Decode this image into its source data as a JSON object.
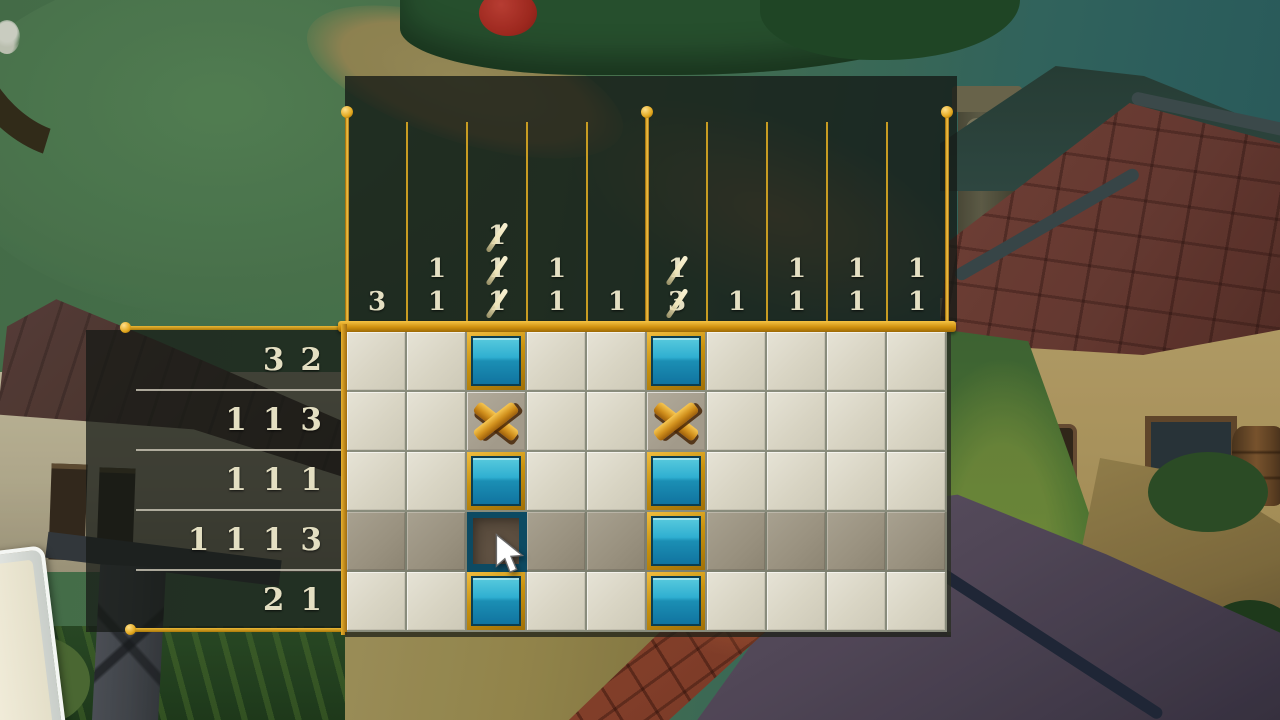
{
  "board": {
    "rows": 5,
    "cols": 10,
    "highlighted_row": 3,
    "hover_cell": {
      "row": 3,
      "col": 2
    },
    "cells": [
      [
        "empty",
        "empty",
        "filled",
        "empty",
        "empty",
        "filled",
        "empty",
        "empty",
        "empty",
        "empty"
      ],
      [
        "empty",
        "empty",
        "x",
        "empty",
        "empty",
        "x",
        "empty",
        "empty",
        "empty",
        "empty"
      ],
      [
        "empty",
        "empty",
        "filled",
        "empty",
        "empty",
        "filled",
        "empty",
        "empty",
        "empty",
        "empty"
      ],
      [
        "empty",
        "empty",
        "hover",
        "empty",
        "empty",
        "filled",
        "empty",
        "empty",
        "empty",
        "empty"
      ],
      [
        "empty",
        "empty",
        "filled",
        "empty",
        "empty",
        "filled",
        "empty",
        "empty",
        "empty",
        "empty"
      ]
    ],
    "row_clues": [
      [
        {
          "n": "3",
          "done": false
        },
        {
          "n": "2",
          "done": false
        }
      ],
      [
        {
          "n": "1",
          "done": false
        },
        {
          "n": "1",
          "done": false
        },
        {
          "n": "3",
          "done": false
        }
      ],
      [
        {
          "n": "1",
          "done": false
        },
        {
          "n": "1",
          "done": false
        },
        {
          "n": "1",
          "done": false
        }
      ],
      [
        {
          "n": "1",
          "done": false
        },
        {
          "n": "1",
          "done": false
        },
        {
          "n": "1",
          "done": false
        },
        {
          "n": "3",
          "done": false
        }
      ],
      [
        {
          "n": "2",
          "done": false
        },
        {
          "n": "1",
          "done": false
        }
      ]
    ],
    "col_clues": [
      [
        {
          "n": "3",
          "done": false
        }
      ],
      [
        {
          "n": "1",
          "done": false
        },
        {
          "n": "1",
          "done": false
        }
      ],
      [
        {
          "n": "1",
          "done": true
        },
        {
          "n": "1",
          "done": true
        },
        {
          "n": "1",
          "done": true
        }
      ],
      [
        {
          "n": "1",
          "done": false
        },
        {
          "n": "1",
          "done": false
        }
      ],
      [
        {
          "n": "1",
          "done": false
        }
      ],
      [
        {
          "n": "1",
          "done": true
        },
        {
          "n": "3",
          "done": true
        }
      ],
      [
        {
          "n": "1",
          "done": false
        }
      ],
      [
        {
          "n": "1",
          "done": false
        },
        {
          "n": "1",
          "done": false
        }
      ],
      [
        {
          "n": "1",
          "done": false
        },
        {
          "n": "1",
          "done": false
        }
      ],
      [
        {
          "n": "1",
          "done": false
        },
        {
          "n": "1",
          "done": false
        }
      ]
    ],
    "colors": {
      "gold_frame": "#d99a14",
      "gold_bright": "#f3c64e",
      "clue_text": "#e4dfc2",
      "panel_bg": "rgba(21,25,22,0.78)",
      "cell_bg": "#d8d4c3",
      "cell_highlight_bg": "#99917f",
      "grid_line": "#898c7c",
      "tile_fill_top": "#2fafd1",
      "tile_fill_bottom": "#1174a0",
      "x_mark": "#d08f1c",
      "hover_border": "#0d4a62",
      "hover_fill": "#544739"
    }
  },
  "cursor": {
    "icon": "arrow-pointer"
  }
}
